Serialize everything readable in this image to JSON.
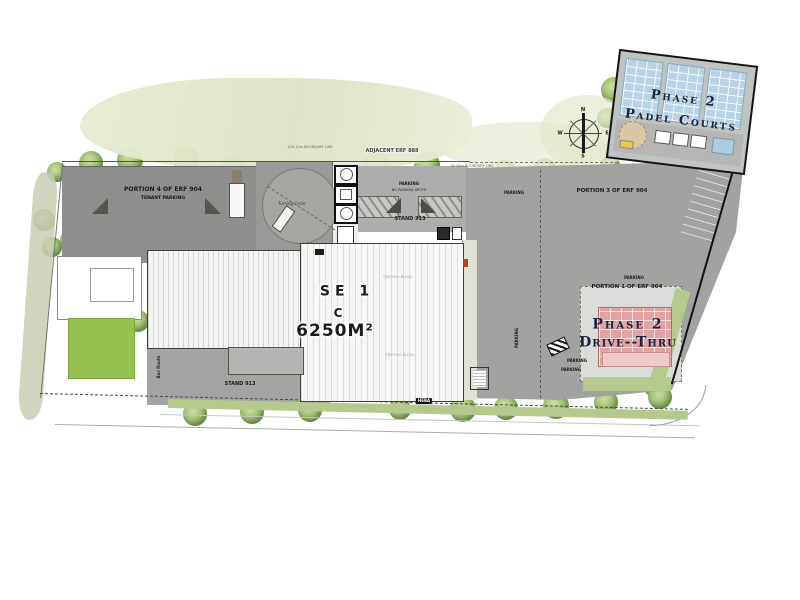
{
  "compass": {
    "north": "N",
    "south": "S",
    "east": "E",
    "west": "W"
  },
  "boundaries": {
    "adjacent": "ADJACENT ERF 888",
    "boundary_left": "100.12m BOUNDARY LINE",
    "boundary_right": "99.48m BOUNDARY LINE"
  },
  "labels": {
    "portion4": "PORTION 4 OF ERF 904",
    "tenant_parking": "TENANT PARKING",
    "turning_circle": "Turning Circle",
    "parking_a": "PARKING",
    "no_parking": "NO PARKING SPOTS",
    "stand913_top": "STAND 913",
    "parking_b": "PARKING",
    "portion3": "PORTION 3 OF ERF 904",
    "parking_c": "PARKING",
    "portion1": "PORTION 1 OF ERF 904",
    "parking_d": "PARKING",
    "parking_e": "PARKING",
    "parking_f": "PARKING",
    "stand913_bottom": "STAND 913",
    "bus_route": "Bus Route",
    "road_name": "HEBA",
    "note_block_a": "EXISTING BLOCK",
    "note_block_b": "EXISTING BLOCK"
  },
  "padel": {
    "line1": "Phase 2",
    "line2": "Padel Courts"
  },
  "drive_thru": {
    "line1": "Phase 2",
    "line2": "Drive--Thru"
  },
  "main_building": {
    "line1": "SE 1",
    "line2": "C",
    "area": "6250M²"
  },
  "colors": {
    "parking_dark": "#8e8e8c",
    "parking_mid": "#a2a2a0",
    "padel_blue": "#b9d3e6",
    "drive_thru_pink": "#e2a3a3",
    "lawn_green": "#96c04f",
    "tree_green": "#93b463",
    "verge_green": "#b5c98c",
    "navy_text": "#1b2240"
  }
}
